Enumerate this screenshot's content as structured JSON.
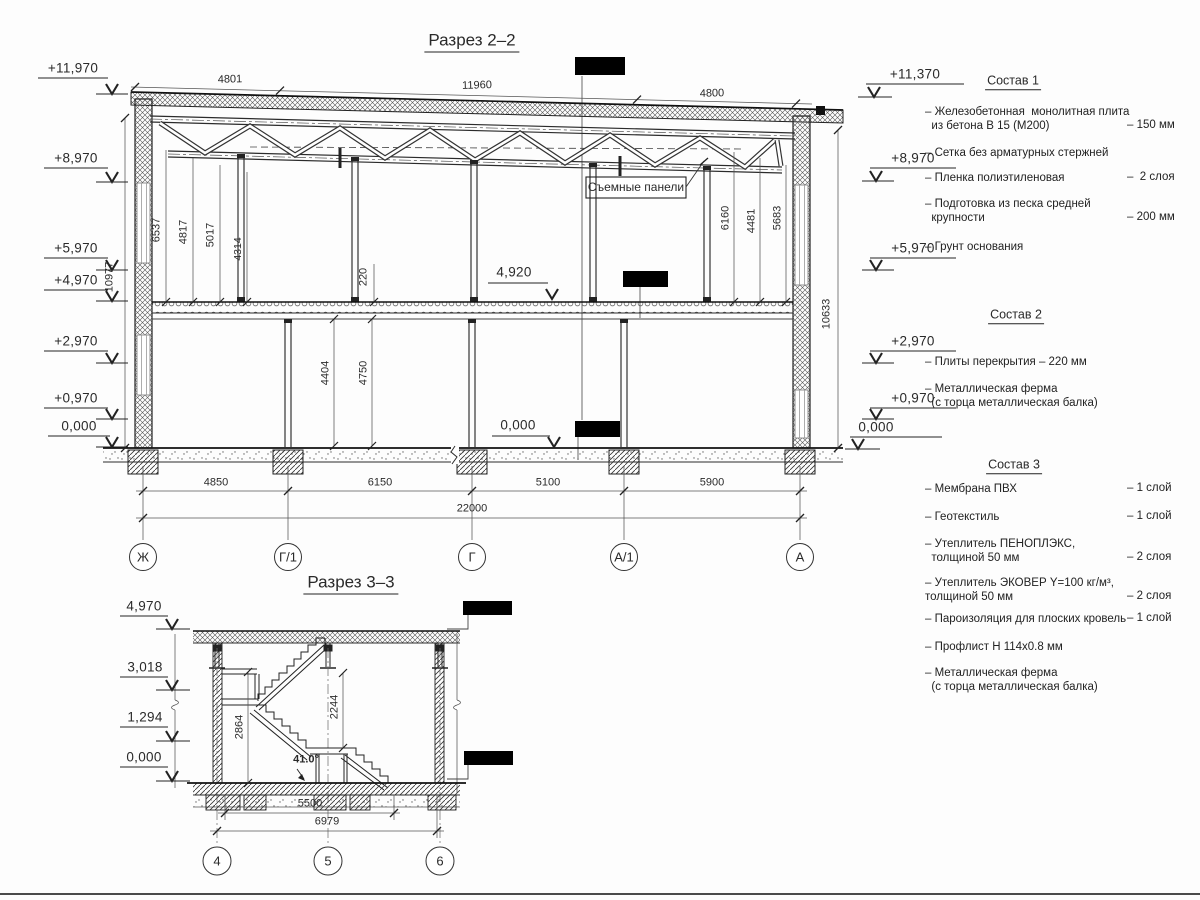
{
  "s22": {
    "title": "Разрез 2–2",
    "top_dims": [
      "4801",
      "11960",
      "4800"
    ],
    "elev_left": [
      "+11,970",
      "+8,970",
      "+5,970",
      "+4,970",
      "+2,970",
      "+0,970",
      "0,000"
    ],
    "elev_right": [
      "+11,370",
      "+8,970",
      "+5,970",
      "+2,970",
      "+0,970",
      "0,000"
    ],
    "height_left": "10977",
    "height_right": "10633",
    "panel_dims_left": [
      "6537",
      "4817",
      "5017",
      "4314"
    ],
    "panel_dims_right": [
      "6160",
      "4481",
      "5683"
    ],
    "slab_thickness": "220",
    "floor_dims": [
      "4404",
      "4750"
    ],
    "floor_elev": "4,920",
    "ground_elev": "0,000",
    "panel_label": "Съемные панели",
    "bottom_dims": [
      "4850",
      "6150",
      "5100",
      "5900"
    ],
    "total_dim": "22000",
    "axes": [
      "Ж",
      "Г/1",
      "Г",
      "А/1",
      "А"
    ]
  },
  "s33": {
    "title": "Разрез 3–3",
    "elevations": [
      "4,970",
      "3,018",
      "1,294",
      "0,000"
    ],
    "stair_dims": [
      "2864",
      "2244"
    ],
    "stair_angle": "41.0°",
    "bottom_dims": [
      "5500",
      "6979"
    ],
    "axes": [
      "4",
      "5",
      "6"
    ]
  },
  "notes": {
    "s1": {
      "title": "Состав 1",
      "items": [
        {
          "t": "– Железобетонная  монолитная плита\n  из бетона В 15 (М200)",
          "v": "– 150 мм"
        },
        {
          "t": "– Сетка без арматурных стержней"
        },
        {
          "t": "– Пленка полиэтиленовая",
          "v": "–  2 слоя"
        },
        {
          "t": "– Подготовка из песка средней\n  крупности",
          "v": "– 200 мм"
        },
        {
          "t": "– Грунт основания"
        }
      ]
    },
    "s2": {
      "title": "Состав 2",
      "items": [
        {
          "t": "– Плиты перекрытия – 220 мм"
        },
        {
          "t": "– Металлическая ферма\n  (с торца металлическая балка)"
        }
      ]
    },
    "s3": {
      "title": "Состав 3",
      "items": [
        {
          "t": "– Мембрана ПВХ",
          "v": "– 1 слой"
        },
        {
          "t": "– Геотекстиль",
          "v": "– 1 слой"
        },
        {
          "t": "– Утеплитель ПЕНОПЛЭКС,\n  толщиной 50 мм",
          "v": "– 2 слоя"
        },
        {
          "t": "– Утеплитель ЭКОВЕР Y=100 кг/м³,\nтолщиной 50 мм",
          "v": "– 2 слоя"
        },
        {
          "t": "– Пароизоляция для плоских кровель",
          "v": "– 1 слой"
        },
        {
          "t": "– Профлист Н 114х0.8 мм"
        },
        {
          "t": "– Металлическая ферма\n  (с торца металлическая балка)"
        }
      ]
    }
  }
}
